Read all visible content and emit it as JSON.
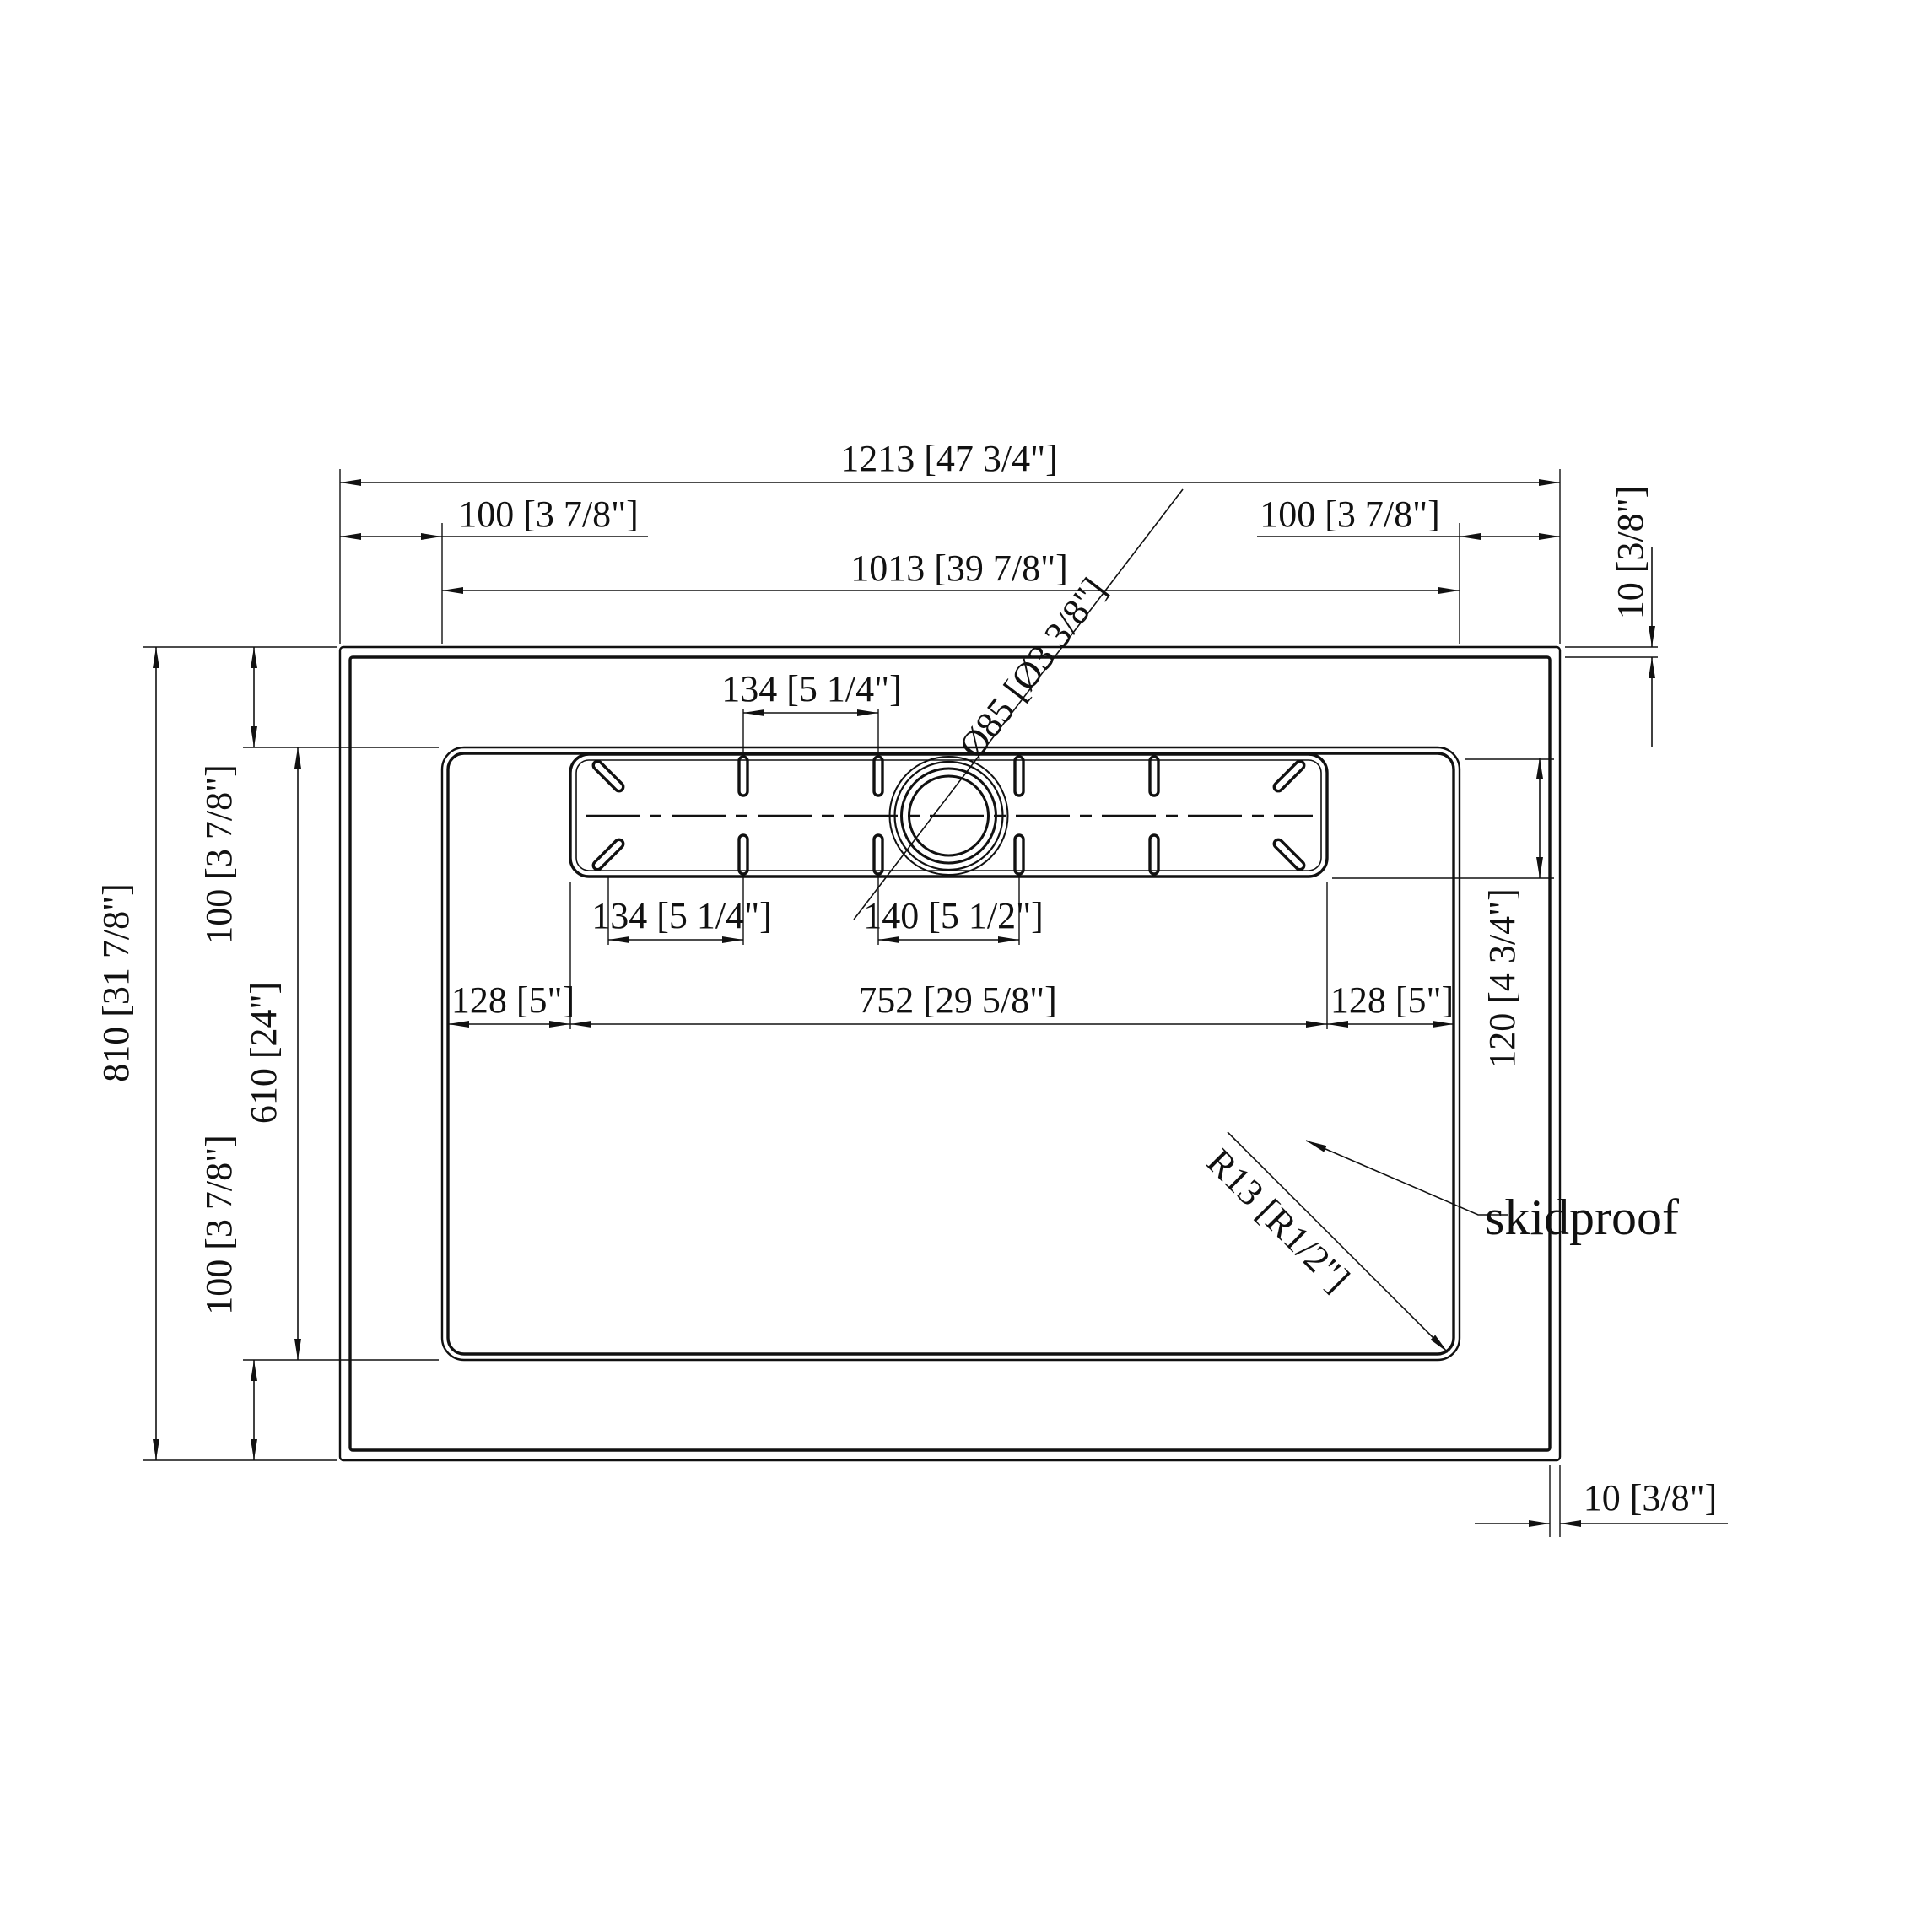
{
  "drawing": {
    "subject": "shower-base-top-view-technical-drawing",
    "background_color": "#ffffff",
    "line_color": "#111111",
    "labels": {
      "overall_width": "1213 [47 3/4\"]",
      "ledge_top_left": "100 [3 7/8\"]",
      "ledge_top_right": "100 [3 7/8\"]",
      "inner_width": "1013 [39 7/8\"]",
      "edge_thickness_top_right": "10 [3/8\"]",
      "overall_depth": "810 [31 7/8\"]",
      "ledge_left_upper": "100 [3 7/8\"]",
      "inner_depth": "610 [24\"]",
      "ledge_left_lower": "100 [3 7/8\"]",
      "slot_pitch_top": "134 [5 1/4\"]",
      "drain_diameter": "Ø85 [Ø3 3/8\"]",
      "slot_pitch_bottom": "134 [5 1/4\"]",
      "drain_slot_pitch": "140 [5 1/2\"]",
      "strip_offset_left": "128 [5\"]",
      "strip_length": "752 [29 5/8\"]",
      "strip_offset_right": "128 [5\"]",
      "strip_depth": "120 [4 3/4\"]",
      "corner_radius": "R13 [R1/2\"]",
      "edge_thickness_bottom_right": "10 [3/8\"]",
      "surface_note": "skidproof"
    }
  }
}
